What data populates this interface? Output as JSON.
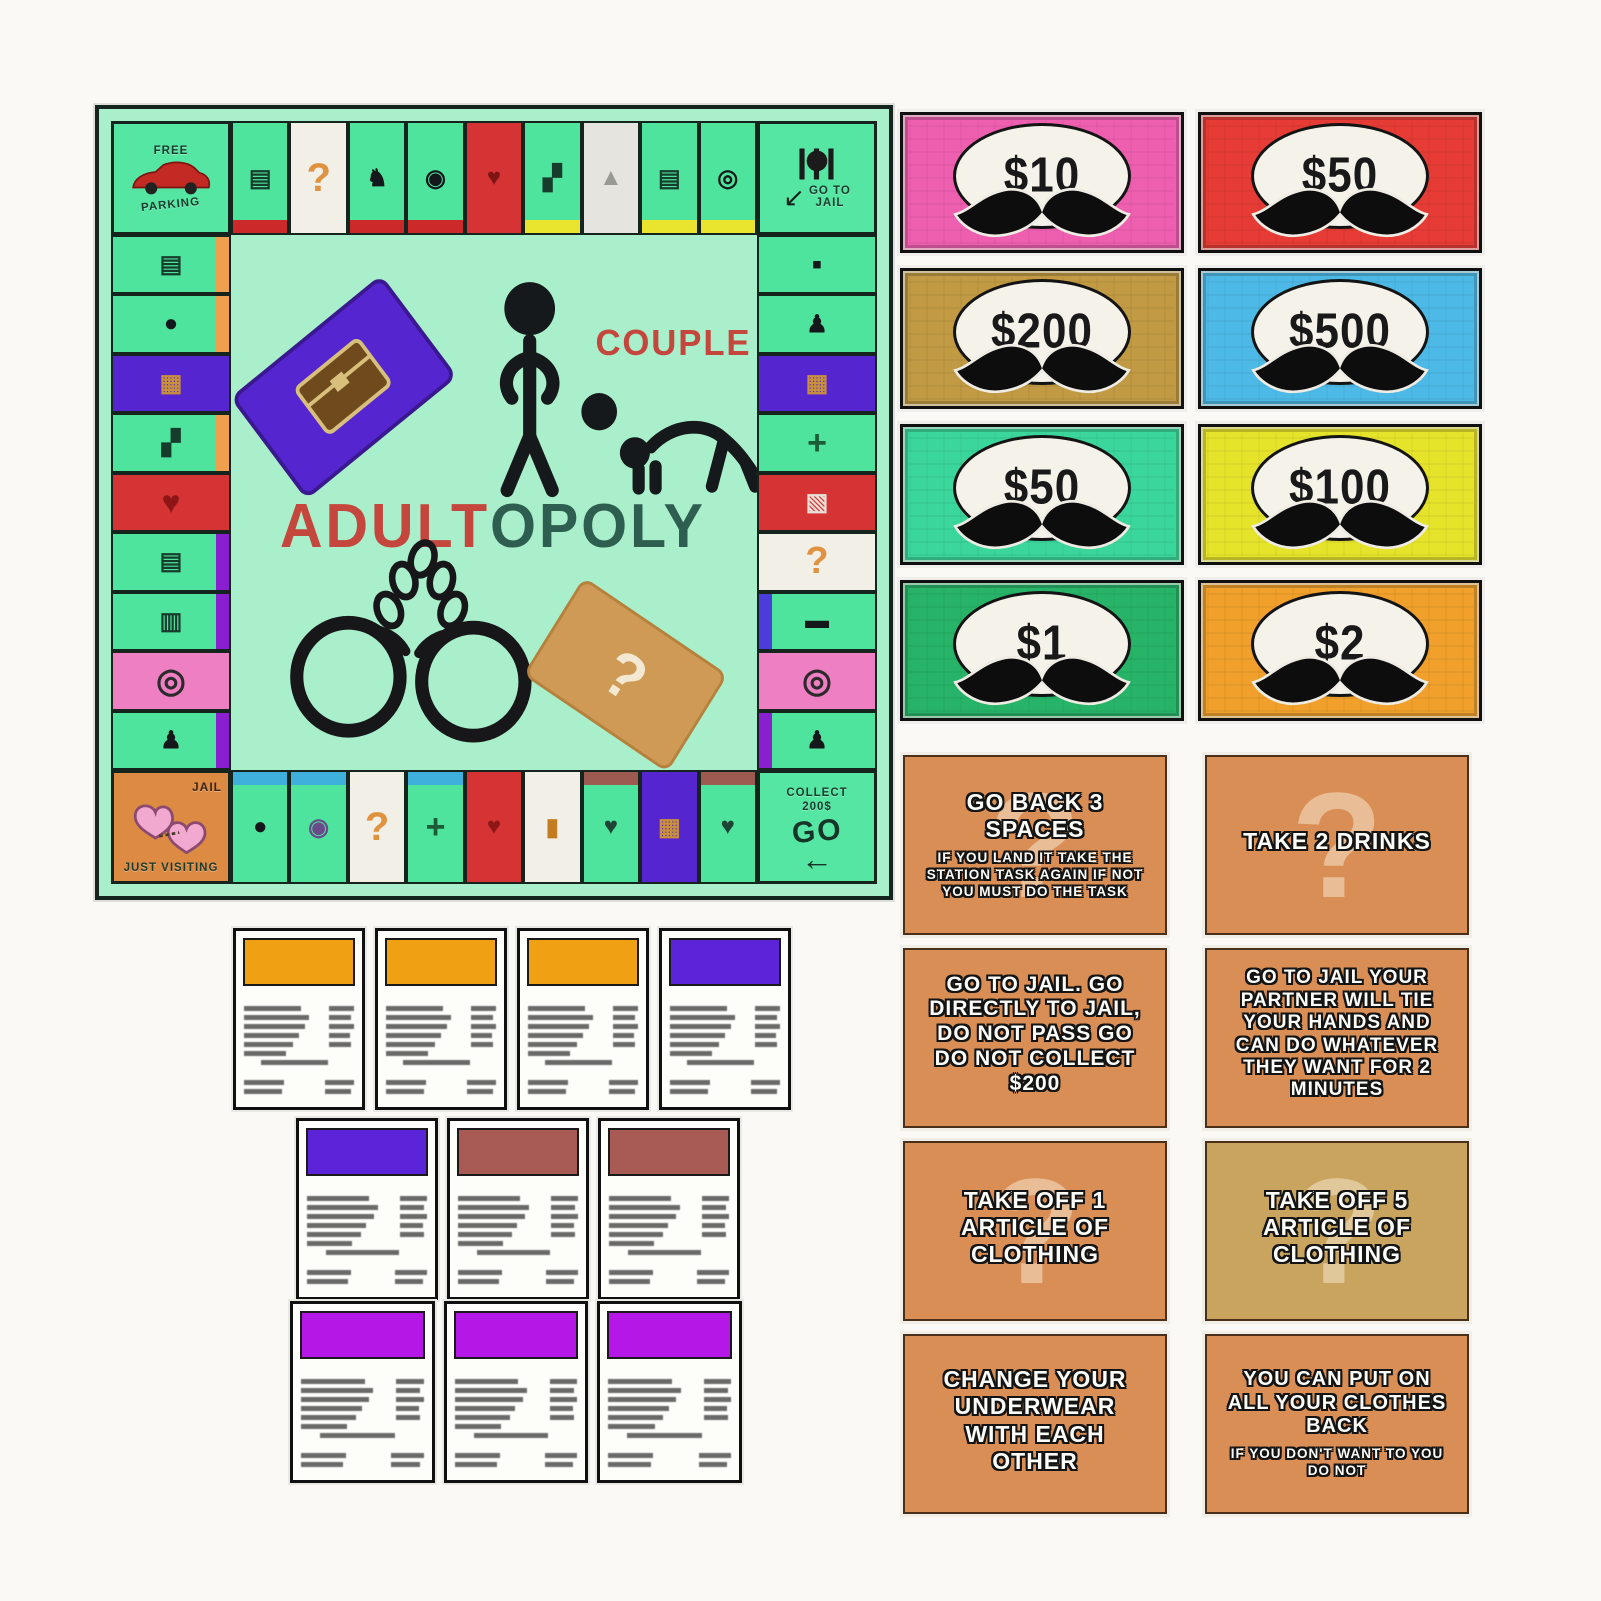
{
  "board": {
    "title": {
      "couple": "COUPLE",
      "part1": "ADULT",
      "part2": "OPOLY",
      "part1_color": "#c4463d",
      "part2_color": "#2e5e50"
    },
    "center_question": "?",
    "corners": {
      "free_parking": {
        "line1": "FREE",
        "line2": "PARKING"
      },
      "go_to_jail": {
        "line1": "GO TO",
        "line2": "JAIL"
      },
      "jail": {
        "label": "JAIL",
        "visiting": "JUST VISITING"
      },
      "go": {
        "collect": "COLLECT",
        "amount": "200$",
        "go": "GO",
        "arrow": "←"
      }
    },
    "colors": {
      "board_bg": "#a9efcb",
      "space_green": "#4fe49d",
      "chest_purple": "#5526cf",
      "chance_white": "#f2efe7",
      "red_space": "#d63434",
      "pink_space": "#ee7fc2",
      "jail_orange": "#dd8a42"
    },
    "spaces_top": [
      {
        "bar": "#cc2a2a",
        "glyph": "▤",
        "gc": "#163c2c"
      },
      {
        "bg": "#f2efe7",
        "glyph": "?",
        "gc": "#df923f",
        "gsize": "40px"
      },
      {
        "bar": "#cc2a2a",
        "glyph": "♞",
        "gc": "#14181a"
      },
      {
        "bar": "#cc2a2a",
        "glyph": "◉",
        "gc": "#14181a"
      },
      {
        "bg": "#d63434",
        "glyph": "♥",
        "gc": "#7e1414"
      },
      {
        "bar": "#e9e42d",
        "glyph": "▞",
        "gc": "#163c2c"
      },
      {
        "bg": "#e6e4de",
        "glyph": "▲",
        "gc": "#9a9a94"
      },
      {
        "bar": "#e9e42d",
        "glyph": "▤",
        "gc": "#163c2c"
      },
      {
        "bar": "#e9e42d",
        "glyph": "◎",
        "gc": "#14181a"
      }
    ],
    "spaces_bottom": [
      {
        "bar": "#3fb0dc",
        "glyph": "●",
        "gc": "#14181a"
      },
      {
        "bar": "#3fb0dc",
        "glyph": "◉",
        "gc": "#6a4a8a"
      },
      {
        "bg": "#f2efe7",
        "glyph": "?",
        "gc": "#df923f",
        "gsize": "40px"
      },
      {
        "bar": "#3fb0dc",
        "glyph": "+",
        "gc": "#1d5c38",
        "gsize": "34px"
      },
      {
        "bg": "#d63434",
        "glyph": "♥",
        "gc": "#8e1616"
      },
      {
        "bg": "#f2efe8",
        "glyph": "▮",
        "gc": "#c47c20"
      },
      {
        "bar": "#9c5a50",
        "glyph": "♥",
        "gc": "#1d4434"
      },
      {
        "bg": "#5526cf",
        "glyph": "▦",
        "gc": "#c8903c"
      },
      {
        "bar": "#9c5a50",
        "glyph": "♥",
        "gc": "#1d4434"
      }
    ],
    "spaces_left": [
      {
        "bar": "#efa04f",
        "glyph": "▤",
        "gc": "#163c2c"
      },
      {
        "bar": "#efa04f",
        "glyph": "●",
        "gc": "#14181a"
      },
      {
        "bg": "#5526cf",
        "glyph": "▦",
        "gc": "#c8903c"
      },
      {
        "bar": "#efa04f",
        "glyph": "▞",
        "gc": "#163c2c"
      },
      {
        "bg": "#d63434",
        "glyph": "♥",
        "gc": "#8e1616",
        "gsize": "32px"
      },
      {
        "bar": "#8a1fd0",
        "glyph": "▤",
        "gc": "#163c2c"
      },
      {
        "bar": "#8a1fd0",
        "glyph": "▥",
        "gc": "#163c2c"
      },
      {
        "bg": "#ee7fc2",
        "glyph": "◎",
        "gc": "#2a2a2a",
        "gsize": "34px"
      },
      {
        "bar": "#8a1fd0",
        "glyph": "♟",
        "gc": "#14181a"
      }
    ],
    "spaces_right": [
      {
        "glyph": "▪",
        "gc": "#14181a",
        "gsize": "30px"
      },
      {
        "glyph": "♟",
        "gc": "#14181a"
      },
      {
        "bg": "#5526cf",
        "glyph": "▦",
        "gc": "#c8903c"
      },
      {
        "glyph": "+",
        "gc": "#1d5c38",
        "gsize": "34px"
      },
      {
        "bg": "#d63434",
        "glyph": "▧",
        "gc": "#e8e0d8"
      },
      {
        "bg": "#f2efe7",
        "glyph": "?",
        "gc": "#df923f",
        "gsize": "38px"
      },
      {
        "bar": "#4a3ddb",
        "glyph": "▬",
        "gc": "#14181a"
      },
      {
        "bg": "#ee7fc2",
        "glyph": "◎",
        "gc": "#2a2a2a",
        "gsize": "34px"
      },
      {
        "bar": "#8a1fd0",
        "glyph": "♟",
        "gc": "#14181a"
      }
    ]
  },
  "money": {
    "bills": [
      {
        "value": "$10",
        "color": "#ef5fb0"
      },
      {
        "value": "$50",
        "color": "#e63c35"
      },
      {
        "value": "$200",
        "color": "#c19a43"
      },
      {
        "value": "$500",
        "color": "#4db9e6"
      },
      {
        "value": "$50",
        "color": "#3bd69c"
      },
      {
        "value": "$100",
        "color": "#e6e32b"
      },
      {
        "value": "$1",
        "color": "#27b468"
      },
      {
        "value": "$2",
        "color": "#f0a02b"
      }
    ]
  },
  "property_cards": {
    "row1": [
      {
        "header": "#f0a113"
      },
      {
        "header": "#f0a113"
      },
      {
        "header": "#f0a113"
      },
      {
        "header": "#5b24d8"
      }
    ],
    "row2": [
      {
        "header": "#5b24d8"
      },
      {
        "header": "#a85a55"
      },
      {
        "header": "#a85a55"
      }
    ],
    "row3": [
      {
        "header": "#b518e6"
      },
      {
        "header": "#b518e6"
      },
      {
        "header": "#b518e6"
      }
    ]
  },
  "action_cards": [
    {
      "title": "GO BACK 3 SPACES",
      "sub": "IF YOU LAND IT TAKE THE STATION TASK AGAIN IF NOT YOU MUST DO THE TASK",
      "color": "#d98e55",
      "watermark": "?"
    },
    {
      "title": "TAKE 2 DRINKS",
      "sub": "",
      "color": "#d98e55",
      "watermark": "?"
    },
    {
      "title": "GO TO JAIL. GO DIRECTLY TO JAIL, DO NOT PASS GO DO NOT COLLECT $200",
      "sub": "",
      "color": "#d98e55",
      "watermark": ""
    },
    {
      "title": "GO TO JAIL YOUR PARTNER WILL TIE YOUR HANDS AND CAN DO WHATEVER THEY WANT FOR 2 MINUTES",
      "sub": "",
      "color": "#d98e55",
      "watermark": ""
    },
    {
      "title": "TAKE OFF 1 ARTICLE OF CLOTHING",
      "sub": "",
      "color": "#d98e55",
      "watermark": "?"
    },
    {
      "title": "TAKE OFF 5 ARTICLE OF CLOTHING",
      "sub": "",
      "color": "#c8a45f",
      "watermark": "?"
    },
    {
      "title": "CHANGE YOUR UNDERWEAR WITH EACH OTHER",
      "sub": "",
      "color": "#d98e55",
      "watermark": ""
    },
    {
      "title": "YOU CAN PUT ON ALL YOUR CLOTHES BACK",
      "sub": "IF YOU DON'T WANT TO YOU DO NOT",
      "color": "#d98e55",
      "watermark": ""
    }
  ]
}
